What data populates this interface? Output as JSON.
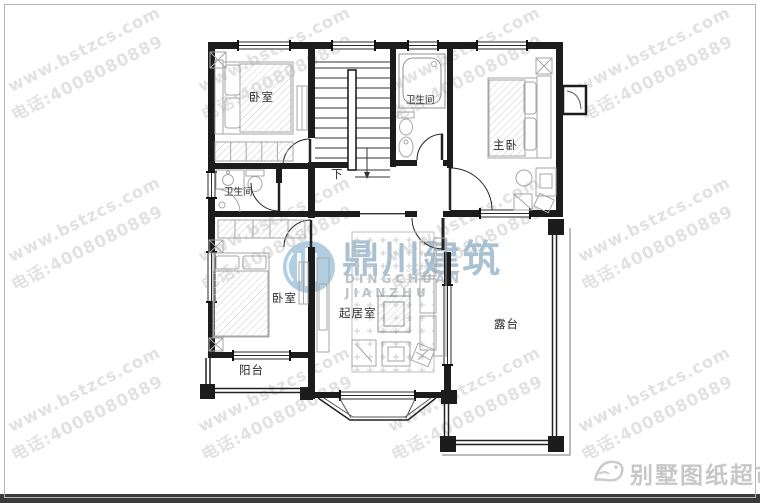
{
  "watermark": {
    "line1": "www.bstzcs.com",
    "line2": "电话:4008080889",
    "color": "#e2e2e2"
  },
  "logo": {
    "name_cn": "鼎川建筑",
    "name_en": "DINGCHUAN JIANZHU",
    "accent_color": "#a9c9e0"
  },
  "rooms": {
    "bedroom_top_left": "卧室",
    "bath_top": "卫生间",
    "master_bedroom": "主卧",
    "bath_left": "卫生间",
    "bedroom_bottom_left": "卧室",
    "living_room": "起居室",
    "terrace": "露台",
    "balcony": "阳台",
    "stairs_down": "下"
  },
  "footer": {
    "brand": "别墅图纸超市"
  }
}
